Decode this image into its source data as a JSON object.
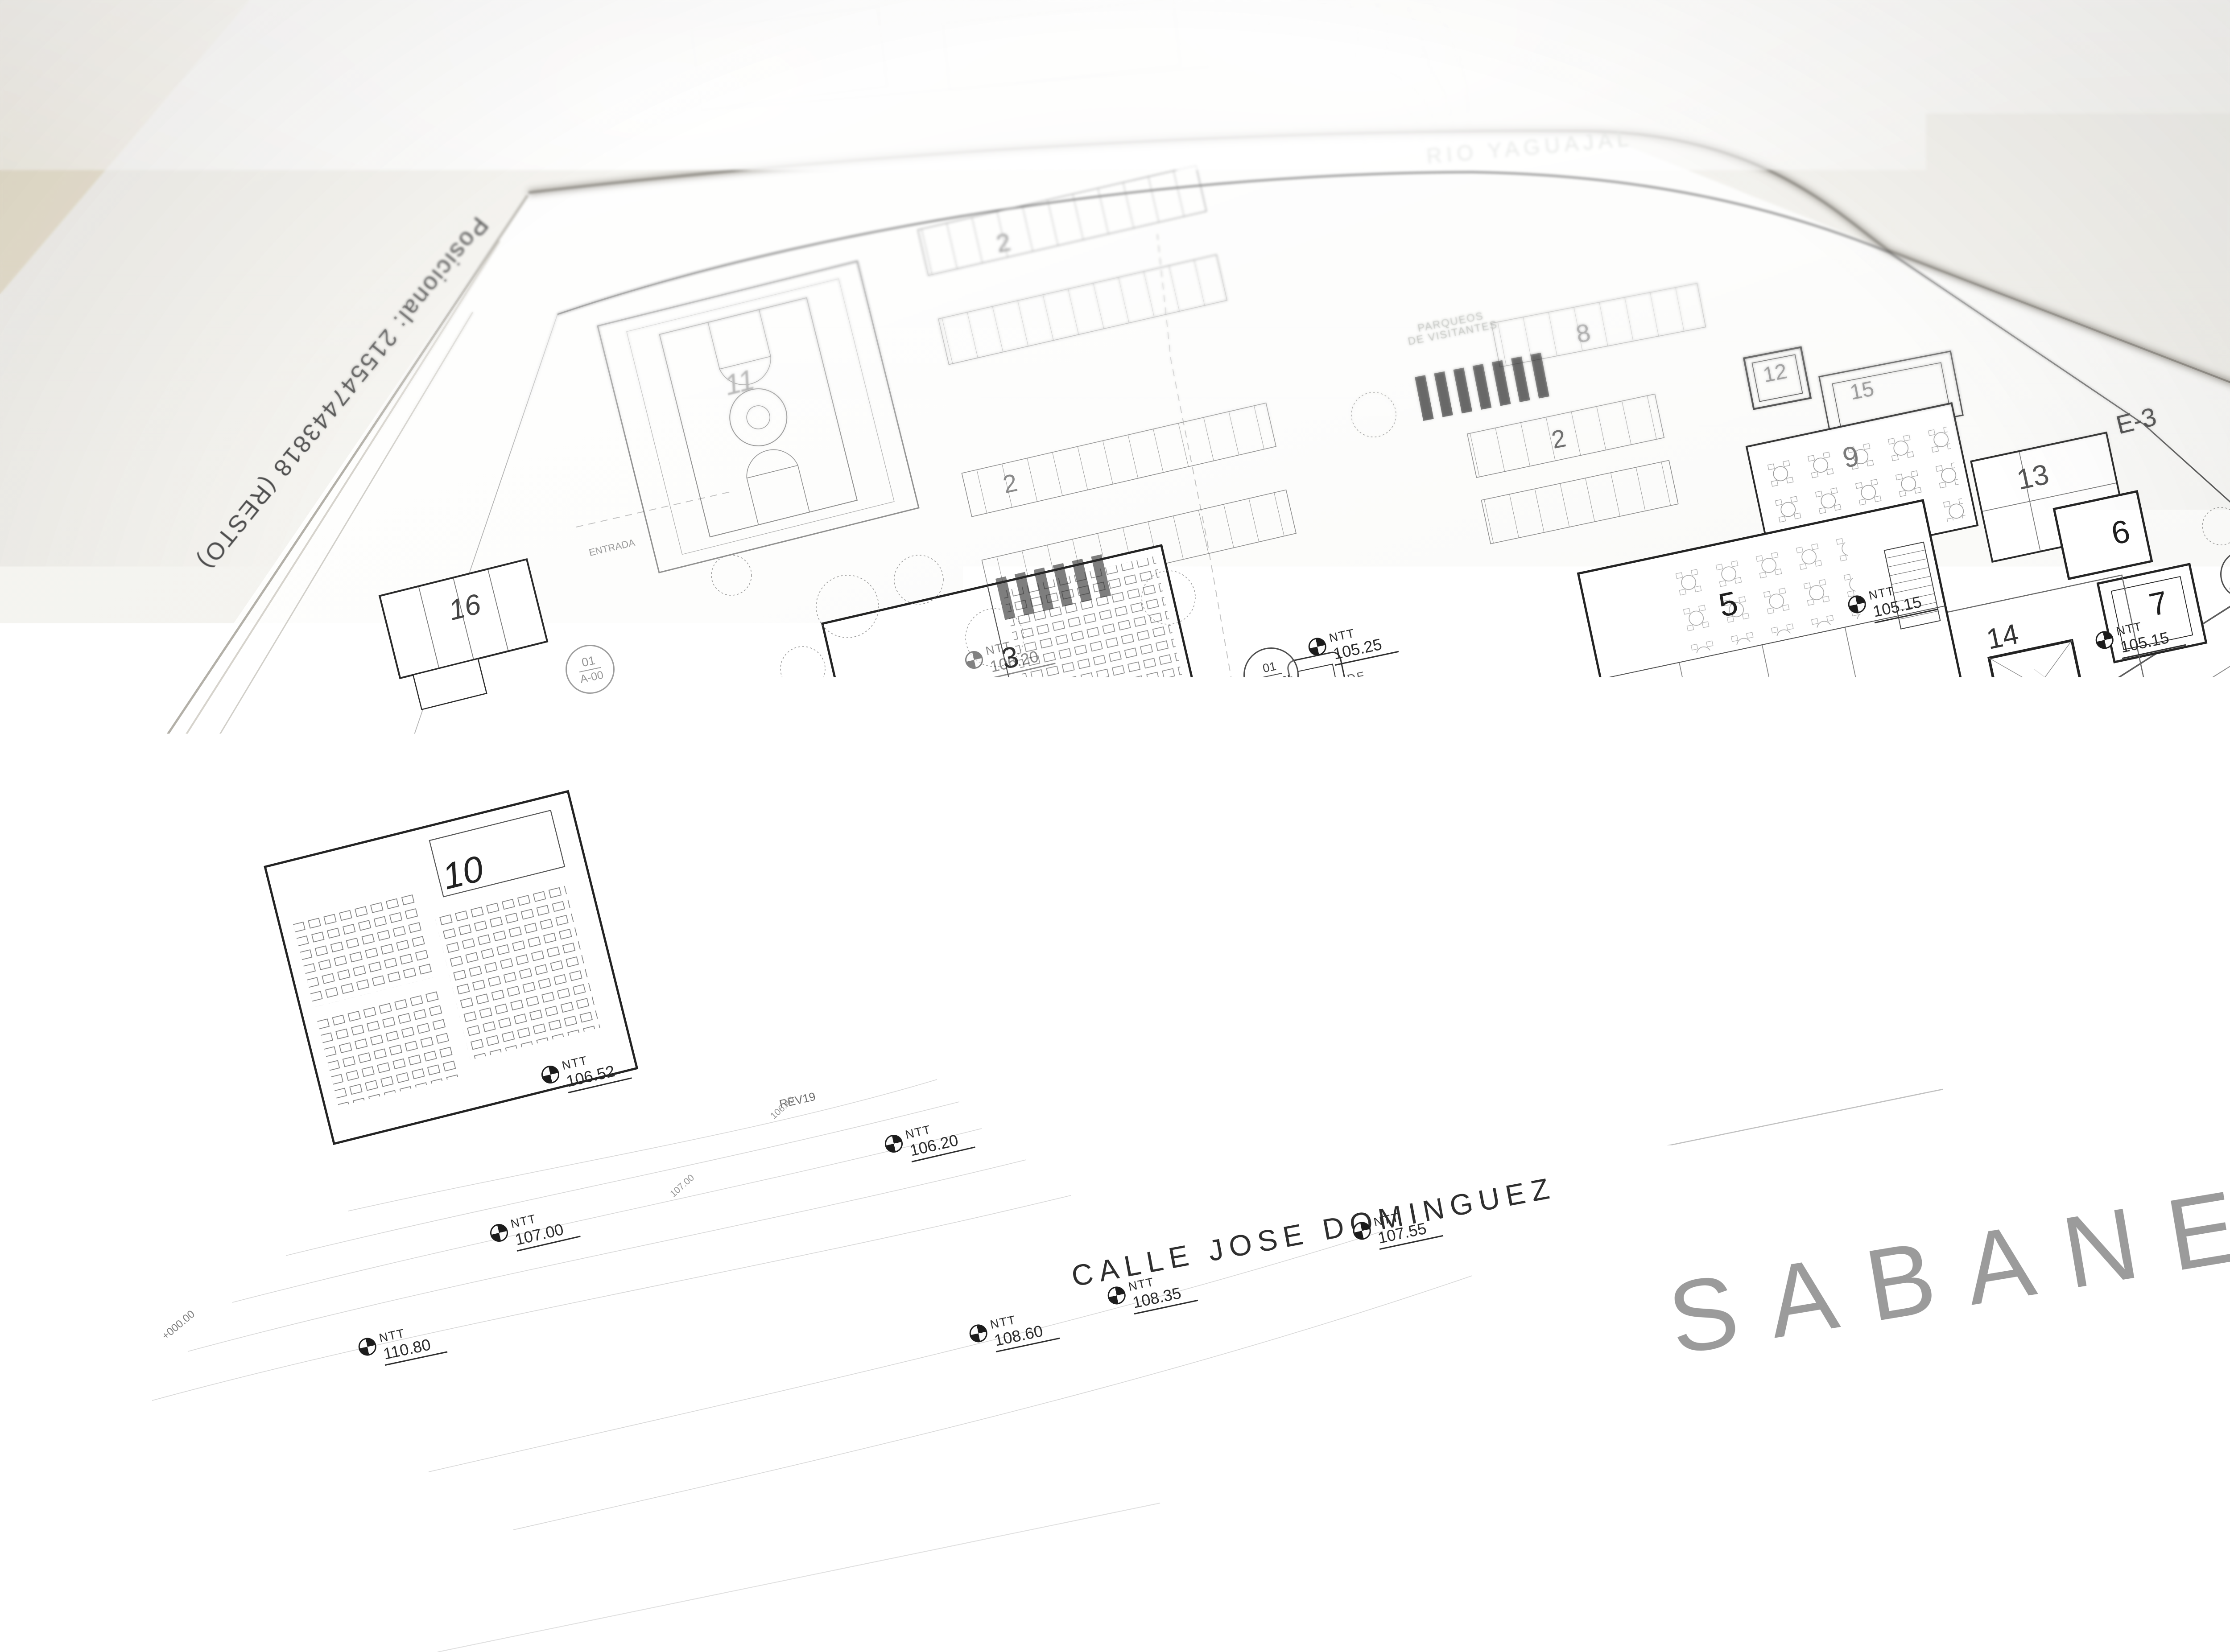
{
  "scene": {
    "desk_color": "#ece6d8",
    "sheet_color": "#fbfbfa",
    "ink_color": "#2f2f2f",
    "city_text_color": "#9b9b9b"
  },
  "sheet": {
    "margin_label": "Posicional: 215547443818 (RESTO)"
  },
  "map": {
    "city_name": "SABANETA",
    "street_main": "CALLE JOSE DOMINGUEZ",
    "street_marginal": "Marginal",
    "river_name": "RIO YAGUAJAL",
    "section_markers": [
      {
        "label": "E-3"
      },
      {
        "label": "E-1"
      }
    ]
  },
  "buildings": [
    {
      "number": "1"
    },
    {
      "number": "2"
    },
    {
      "number": "2"
    },
    {
      "number": "2"
    },
    {
      "number": "3"
    },
    {
      "number": "4"
    },
    {
      "number": "5"
    },
    {
      "number": "6"
    },
    {
      "number": "7"
    },
    {
      "number": "8"
    },
    {
      "number": "9"
    },
    {
      "number": "10"
    },
    {
      "number": "11"
    },
    {
      "number": "12"
    },
    {
      "number": "13"
    },
    {
      "number": "14"
    },
    {
      "number": "15"
    },
    {
      "number": "16"
    }
  ],
  "detail_bubbles": [
    {
      "number": "01",
      "sheet": "AS-500b"
    },
    {
      "number": "01",
      "sheet": "AS-500b"
    },
    {
      "number": "01",
      "sheet": "A-00"
    },
    {
      "number": "01",
      "sheet": "A-00"
    },
    {
      "number": "03",
      "sheet": "A-500d"
    }
  ],
  "elevation_markers": [
    {
      "type": "NTT",
      "value": "105.25"
    },
    {
      "type": "NTT",
      "value": "105.40"
    },
    {
      "type": "NTT",
      "value": "105.90"
    },
    {
      "type": "NTT",
      "value": "105.35"
    },
    {
      "type": "NTT",
      "value": "105.40"
    },
    {
      "type": "NTT",
      "value": "105.30"
    },
    {
      "type": "NTT",
      "value": "105.30"
    },
    {
      "type": "NTT",
      "value": "105.15"
    },
    {
      "type": "NTT",
      "value": "105.15"
    },
    {
      "type": "NTT",
      "value": "105.45"
    },
    {
      "type": "NTT",
      "value": "105.20"
    },
    {
      "type": "NTT",
      "value": "105.70"
    },
    {
      "type": "NTT",
      "value": "105.40"
    },
    {
      "type": "NTT",
      "value": "106.20"
    },
    {
      "type": "NTT",
      "value": "106.52"
    },
    {
      "type": "NTT",
      "value": "107.00"
    },
    {
      "type": "NTT",
      "value": "106.20"
    },
    {
      "type": "NTT",
      "value": "106.20"
    },
    {
      "type": "NTT",
      "value": "108.60"
    },
    {
      "type": "NTT",
      "value": "107.55"
    },
    {
      "type": "NTT",
      "value": "108.35"
    },
    {
      "type": "NTT",
      "value": "110.80"
    },
    {
      "type": "NPT",
      "value": "106.20"
    },
    {
      "type": "NTT",
      "value": "106.20"
    }
  ],
  "annotations": {
    "garita": "GARITA DE\nSEGURIDAD",
    "parqueos": "PARQUEOS\nDE VISITANTES",
    "mural_definir": "MURAL A\nDEFINIR",
    "mural": "MURAL",
    "entrada": "ENTRADA",
    "asta": "Asta",
    "jardinera": "Jardinera",
    "slope_p4": "P4%",
    "slope_p39": "P 3.9%",
    "slope_625": "6.25%",
    "dim_928": "9.28",
    "rev19": "REV19",
    "station": "+000.00"
  },
  "contour_labels": [
    "105.80",
    "105.60",
    "105.20",
    "104.80",
    "106.40",
    "107.00"
  ]
}
